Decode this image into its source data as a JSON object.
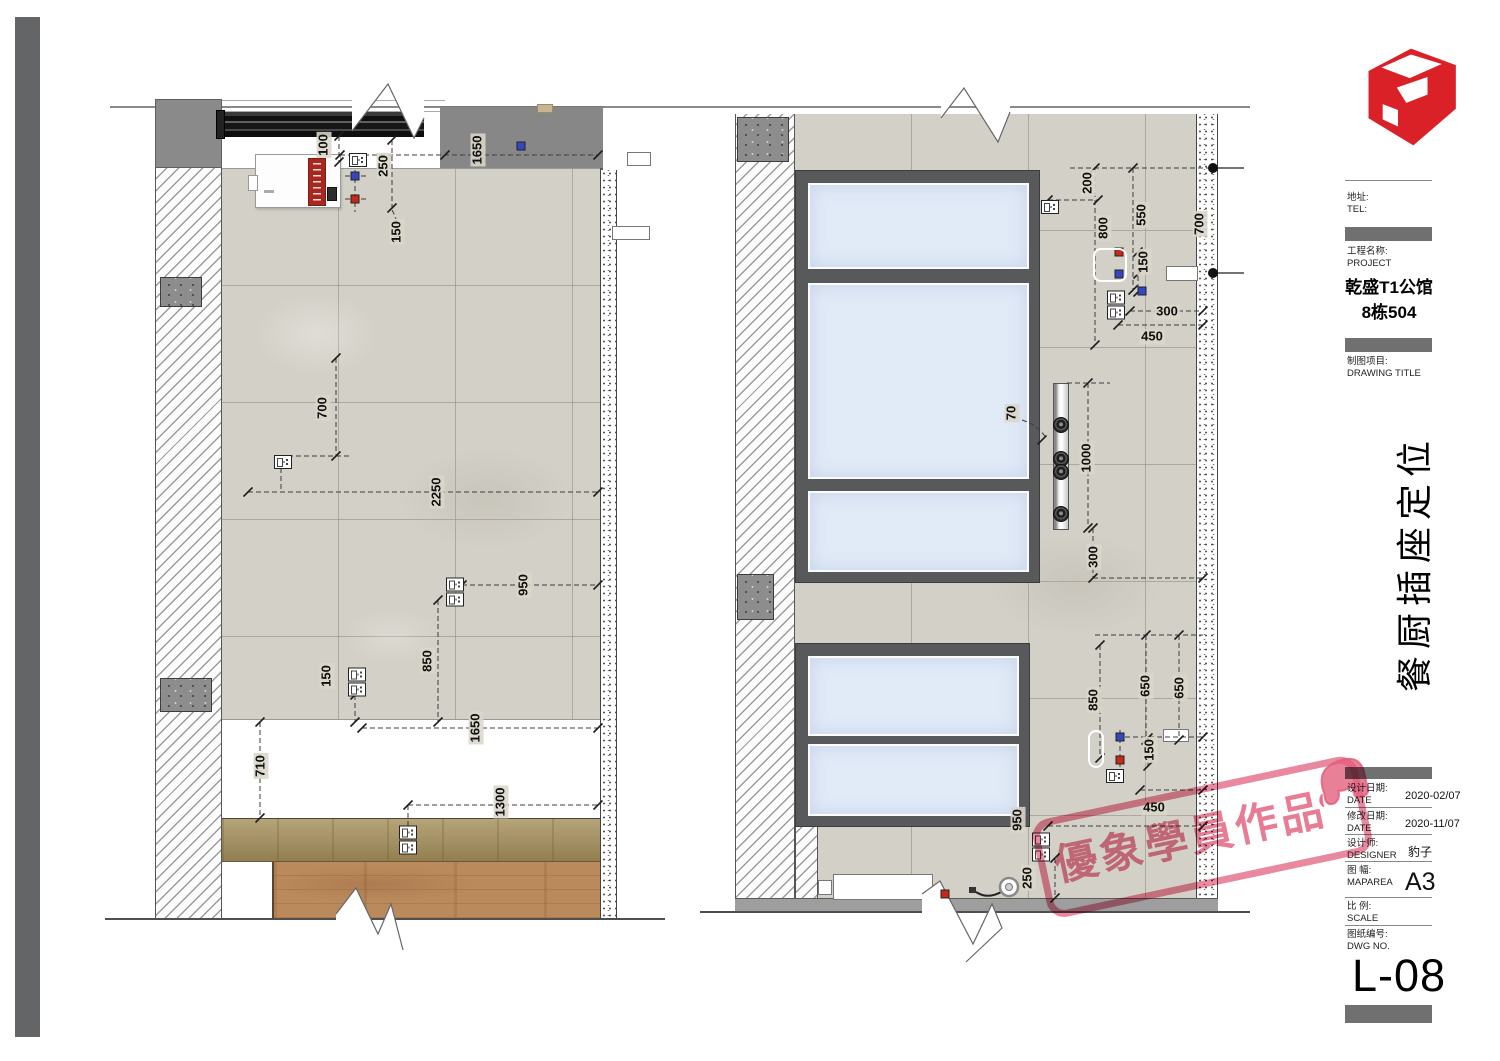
{
  "title_block": {
    "address_label": "地址:",
    "tel_label": "TEL:",
    "project_label": "工程名称:",
    "project_label_en": "PROJECT",
    "project_name_line1": "乾盛T1公馆",
    "project_name_line2": "8栋504",
    "drawing_title_label": "制图项目:",
    "drawing_title_label_en": "DRAWING TITLE",
    "drawing_title_vertical": "餐厨插座定位",
    "design_date_label": "设计日期:",
    "design_date_label_en": "DATE",
    "design_date": "2020-02/07",
    "revise_date_label": "修改日期:",
    "revise_date_label_en": "DATE",
    "revise_date": "2020-11/07",
    "designer_label": "设计师:",
    "designer_label_en": "DESIGNER",
    "designer": "豹子",
    "map_area_label": "图 幅:",
    "map_area_label_en": "MAPAREA",
    "map_area": "A3",
    "scale_label": "比 例:",
    "scale_label_en": "SCALE",
    "scale": "",
    "dwg_no_label": "图纸编号:",
    "dwg_no_label_en": "DWG NO.",
    "dwg_no": "L-08"
  },
  "stamp": {
    "text": "優象學員作品",
    "color": "#E15C7A"
  },
  "logo": {
    "name": "sketchup-logo",
    "color": "#DA2128"
  },
  "colors": {
    "tile": "#D3D0C7",
    "window_glass": "#E1EAF7",
    "window_frame": "#58595B",
    "marker_blue": "#3447C0",
    "marker_red": "#C8281A"
  },
  "left_elevation": {
    "dims": [
      {
        "v": "100",
        "x": 324,
        "y": 145,
        "o": "v"
      },
      {
        "v": "250",
        "x": 384,
        "y": 166,
        "o": "v"
      },
      {
        "v": "150",
        "x": 397,
        "y": 232,
        "o": "v"
      },
      {
        "v": "1650",
        "x": 478,
        "y": 150,
        "o": "v"
      },
      {
        "v": "700",
        "x": 323,
        "y": 408,
        "o": "v"
      },
      {
        "v": "2250",
        "x": 437,
        "y": 492,
        "o": "v"
      },
      {
        "v": "950",
        "x": 524,
        "y": 585,
        "o": "v"
      },
      {
        "v": "150",
        "x": 327,
        "y": 676,
        "o": "v"
      },
      {
        "v": "850",
        "x": 428,
        "y": 661,
        "o": "v"
      },
      {
        "v": "1650",
        "x": 476,
        "y": 728,
        "o": "v"
      },
      {
        "v": "710",
        "x": 261,
        "y": 766,
        "o": "v"
      },
      {
        "v": "1300",
        "x": 501,
        "y": 802,
        "o": "v"
      }
    ],
    "sockets": [
      {
        "x": 358,
        "y": 160,
        "t": "s"
      },
      {
        "x": 283,
        "y": 462,
        "t": "s"
      },
      {
        "x": 455,
        "y": 592,
        "t": "d"
      },
      {
        "x": 357,
        "y": 682,
        "t": "d"
      },
      {
        "x": 408,
        "y": 840,
        "t": "d"
      }
    ],
    "markers": [
      {
        "x": 355,
        "y": 176,
        "c": "b"
      },
      {
        "x": 355,
        "y": 199,
        "c": "r"
      },
      {
        "x": 521,
        "y": 146,
        "c": "b"
      }
    ]
  },
  "right_elevation": {
    "dims": [
      {
        "v": "200",
        "x": 1088,
        "y": 183,
        "o": "v"
      },
      {
        "v": "550",
        "x": 1142,
        "y": 215,
        "o": "v"
      },
      {
        "v": "800",
        "x": 1104,
        "y": 228,
        "o": "v"
      },
      {
        "v": "700",
        "x": 1200,
        "y": 224,
        "o": "v"
      },
      {
        "v": "150",
        "x": 1144,
        "y": 262,
        "o": "v"
      },
      {
        "v": "300",
        "x": 1167,
        "y": 312,
        "o": "h"
      },
      {
        "v": "450",
        "x": 1152,
        "y": 337,
        "o": "h"
      },
      {
        "v": "70",
        "x": 1012,
        "y": 413,
        "o": "v"
      },
      {
        "v": "1000",
        "x": 1087,
        "y": 458,
        "o": "v"
      },
      {
        "v": "300",
        "x": 1094,
        "y": 557,
        "o": "v"
      },
      {
        "v": "850",
        "x": 1094,
        "y": 700,
        "o": "v"
      },
      {
        "v": "650",
        "x": 1146,
        "y": 686,
        "o": "v"
      },
      {
        "v": "650",
        "x": 1180,
        "y": 688,
        "o": "v"
      },
      {
        "v": "150",
        "x": 1150,
        "y": 750,
        "o": "v"
      },
      {
        "v": "450",
        "x": 1154,
        "y": 808,
        "o": "h"
      },
      {
        "v": "950",
        "x": 1018,
        "y": 820,
        "o": "v"
      },
      {
        "v": "250",
        "x": 1028,
        "y": 878,
        "o": "v"
      }
    ],
    "sockets": [
      {
        "x": 1050,
        "y": 207,
        "t": "s"
      },
      {
        "x": 1116,
        "y": 305,
        "t": "d"
      },
      {
        "x": 1115,
        "y": 776,
        "t": "s"
      },
      {
        "x": 1041,
        "y": 847,
        "t": "d"
      }
    ],
    "markers": [
      {
        "x": 1119,
        "y": 252,
        "c": "r"
      },
      {
        "x": 1119,
        "y": 274,
        "c": "b"
      },
      {
        "x": 1142,
        "y": 291,
        "c": "b"
      },
      {
        "x": 1120,
        "y": 737,
        "c": "b"
      },
      {
        "x": 1120,
        "y": 760,
        "c": "r"
      },
      {
        "x": 945,
        "y": 894,
        "c": "r"
      }
    ],
    "power_track": {
      "outlets_y": [
        424,
        458,
        471,
        513
      ]
    },
    "wall_dots": [
      {
        "x": 1213,
        "y": 168
      },
      {
        "x": 1213,
        "y": 273
      }
    ]
  }
}
